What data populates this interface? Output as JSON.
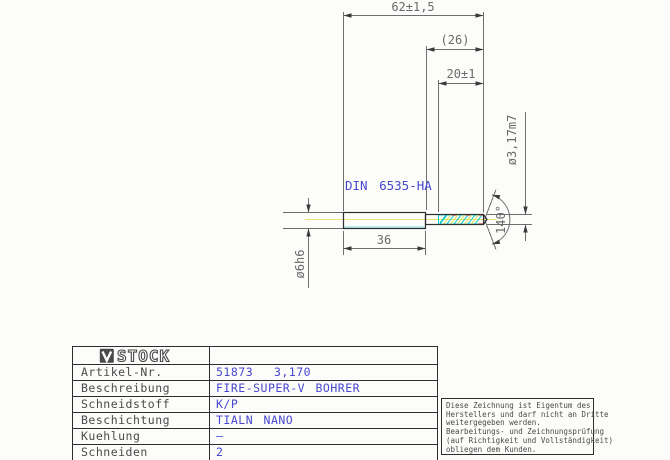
{
  "drawing": {
    "norm_label": "DIN 6535-HA",
    "dims": {
      "overall_length": "62±1,5",
      "ref_length": "(26)",
      "flute_length": "20±1",
      "flute_diameter": "ø3,17m7",
      "point_angle": "140°",
      "shank_length": "36",
      "shank_diameter": "ø6h6"
    },
    "colors": {
      "outline": "#2e2e2e",
      "dimension_gray": "#6e6e6e",
      "annotation_blue": "#4747cf",
      "flute_cyan": "#00c6c6",
      "centerline_yellow": "#e6e670",
      "flute_red": "#d96a5f"
    }
  },
  "titleblock": {
    "logo": "STOCK",
    "rows": [
      {
        "label": "Artikel-Nr.",
        "value": "51873  3,170"
      },
      {
        "label": "Beschreibung",
        "value": "FIRE-SUPER-V BOHRER"
      },
      {
        "label": "Schneidstoff",
        "value": "K/P"
      },
      {
        "label": "Beschichtung",
        "value": "TIALN NANO"
      },
      {
        "label": "Kuehlung",
        "value": "–"
      },
      {
        "label": "Schneiden",
        "value": "2"
      }
    ]
  },
  "notice": {
    "lines": [
      "Diese Zeichnung ist Eigentum des",
      "Herstellers und darf nicht an Dritte",
      "weitergegeben werden.",
      "Bearbeitungs- und Zeichnungsprüfung",
      "(auf Richtigkeit und Vollständigkeit)",
      "obliegen dem Kunden."
    ]
  }
}
